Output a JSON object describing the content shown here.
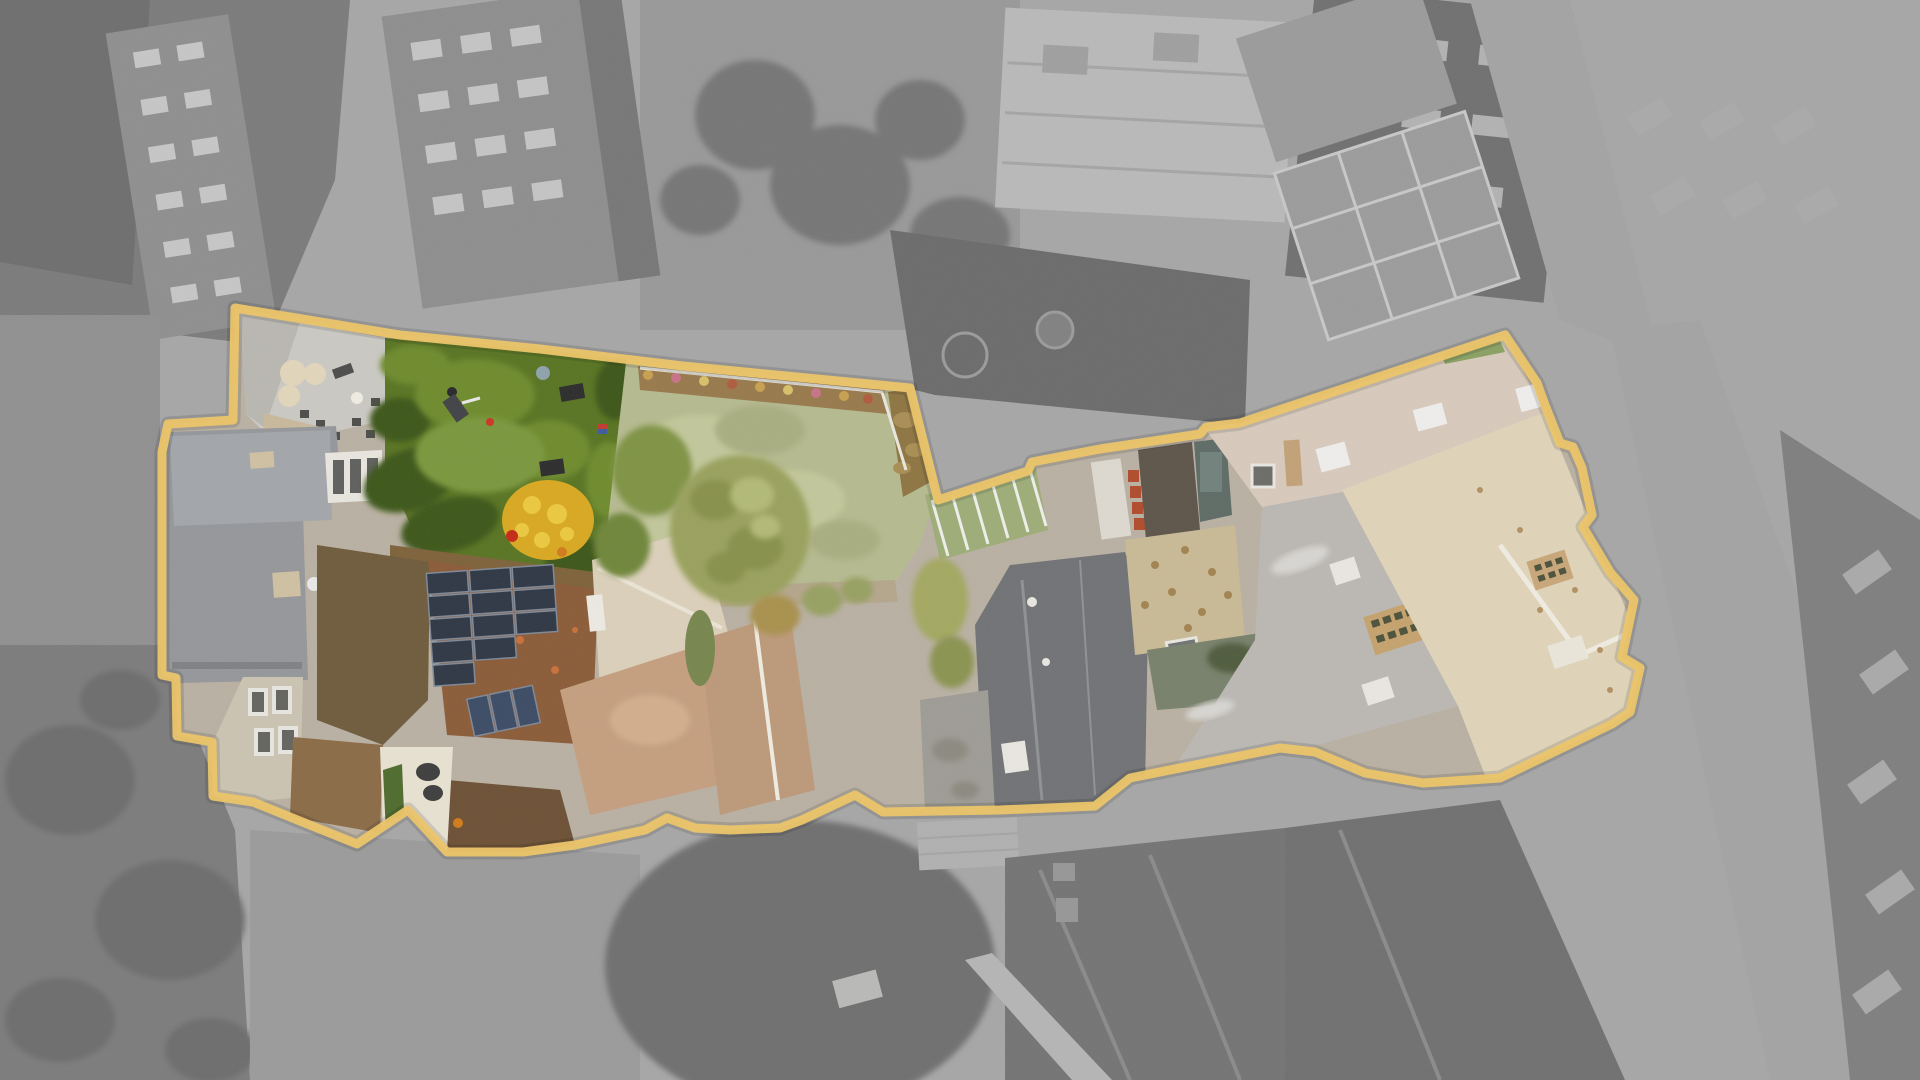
{
  "meta": {
    "kind": "aerial-drone-photograph",
    "subject": "property-plot-highlight",
    "description": "Top-down aerial photo; plot outlined in gold, interior in color, surroundings desaturated gray"
  },
  "boundary": {
    "color": "#eec566",
    "shadow": "rgba(0,0,0,0.12)",
    "stroke_width": 9,
    "shadow_width": 15
  },
  "colors": {
    "bg_base": "#a6a6a6",
    "block_dark": "#7a7a7a",
    "brick_dark": "#6d6d6d",
    "bldg_win": "#8e8e8e",
    "win_light": "#c6c6c6",
    "bldg2": "#8d8d8d",
    "bldg2_dark": "#767676",
    "win_light2": "#c4c4c4",
    "yard_top": "#989898",
    "tree_dark": "#757575",
    "roof_light": "#b9b9b9",
    "roof_line": "#a4a4a4",
    "vent": "#9f9f9f",
    "dark_bldg": "#6f6f6f",
    "win_light3": "#b2b2b2",
    "neighbor_yard": "#6a6a6a",
    "yard_ring": "#9a9a9a",
    "tramp": "#808080",
    "solar_gray": "#9b9b9b",
    "solar_gray_line": "#c8c8c8",
    "speckle_roof": "#9a9a9a",
    "street": "#a3a3a3",
    "facade_right": "#7e7e7e",
    "win_light4": "#a9a9a9",
    "left_strip": "#8f8f8f",
    "yard_dark": "#7b7b7b",
    "tree_blob": "#6c6c6c",
    "road": "#9a9a9a",
    "garage_light": "#b0b0b0",
    "branch_tree": "#6e6e6e",
    "car_white": "#b9b9b7",
    "roof_dark": "#737373",
    "ridge_light": "#8a8a8a",
    "skylight_gray": "#969696",
    "walkway_light": "#b5b5b5",
    "roof_dark2": "#6f6f6f",
    "base_court": "#b9b0a2",
    "patio": "#cbc9c3",
    "patio_shade": "#b9b7b0",
    "table_cream": "#e2d6ba",
    "table_white": "#f0ece2",
    "furn_dark": "#4b4b49",
    "brick_path": "#c9b89a",
    "slate": "#94969a",
    "slate_light": "#a2a5a9",
    "slate_dark": "#7e8084",
    "chimney_tan_l": "#cfc0a0",
    "dish_white": "#e9e9e7",
    "facade_pale": "#cbc3b2",
    "window_frame": "#e8e6e0",
    "window_dark": "#62625e",
    "bay_white": "#e9e6df",
    "bay_slot": "#5e5e5c",
    "garden": "#577320",
    "bush_dark": "#3a5415",
    "bush_mid": "#6d8a2c",
    "grass_light": "#79973a",
    "dirt_path": "#7d6138",
    "yellow_bush": "#d9a81e",
    "yellow_hi": "#ecc93e",
    "orange_dot": "#d07a18",
    "person": "#3f4145",
    "person_head": "#26262a",
    "arm_white": "#e8e8e8",
    "red_person": "#c42814",
    "red_flower": "#cc3322",
    "bin_dark": "#2a2a2a",
    "flag_red": "#c0392b",
    "flag_blue": "#3a5a9a",
    "sphere": "#8ea2ac",
    "moss_roof": "#6e5a3a",
    "brown_roof": "#8a6a45",
    "rust": "#8a5a36",
    "rust_dot": "#c96f38",
    "dark_tiles": "#6b4f33",
    "solar": "#2c3542",
    "solar_edge": "#7e8796",
    "solar2": "#3a4a63",
    "court_white": "#e8e2d2",
    "vine": "#4d6a2b",
    "obj_dark": "#3c3c3c",
    "lawn": "#b5ba8e",
    "lawn_light": "#c2c79a",
    "lawn_dark": "#a8ad80",
    "bed_brown": "#97784a",
    "dot_tan": "#c8a04e",
    "dot_pink": "#c87286",
    "dot_yellow": "#d8c068",
    "dot_rust": "#b05a3a",
    "bed_right": "#8d7440",
    "bed_speck": "#a88d52",
    "path_tan": "#b5a68c",
    "cream_roof": "#dcd0ba",
    "cream_ridge": "#ece5d6",
    "orange_roof": "#c49e7e",
    "orange_light": "#d2ae8c",
    "rust_washed": "#bc9878",
    "conservatory": "#eceae2",
    "tree_green": "#7e9343",
    "tree_green2": "#6e8539",
    "tree_olive": "#99a15c",
    "tree_olive_dark": "#879048",
    "tree_olive_light": "#b2ba75",
    "tree_col": "#76854c",
    "tree_orange": "#a8904c",
    "tree_small": "#96a060",
    "tree_lime": "#a2a85e",
    "tree_lime2": "#8a9350",
    "greenhouse": "#9dac76",
    "gh_line": "#eef0ea",
    "path_white": "#ddd9d0",
    "red_strip": "#b04a2a",
    "yard_brown": "#5c5348",
    "teal": "#5d6a64",
    "teal_light": "#70807b",
    "charcoal": "#6f7174",
    "charcoal_ridge": "#8e9093",
    "sky_white": "#e9e7e0",
    "flat_gray": "#9d9b94",
    "stain": "#8b897f",
    "cobble": "#c9ba94",
    "cobble_speck": "#a2824f",
    "green_yard": "#77806a",
    "green_bush": "#4e5a3a",
    "slate_right": "#bbb8b4",
    "slate_splotch": "#d8d6d2",
    "chim_tan": "#c5a26c",
    "chim_hole": "#4a5038",
    "band": "#d8cabc",
    "band_sky": "#efeeec",
    "band_green": "#89a061",
    "band_chim": "#c2a176",
    "band_block": "#6a6a66",
    "cream_rough": "#e0d4b8",
    "white_ridge": "#f0ece2",
    "chim_tan2": "#c9a678",
    "white_block": "#eae6da",
    "cream_speck": "#b2905e",
    "edge_white": "#e9e7df"
  }
}
